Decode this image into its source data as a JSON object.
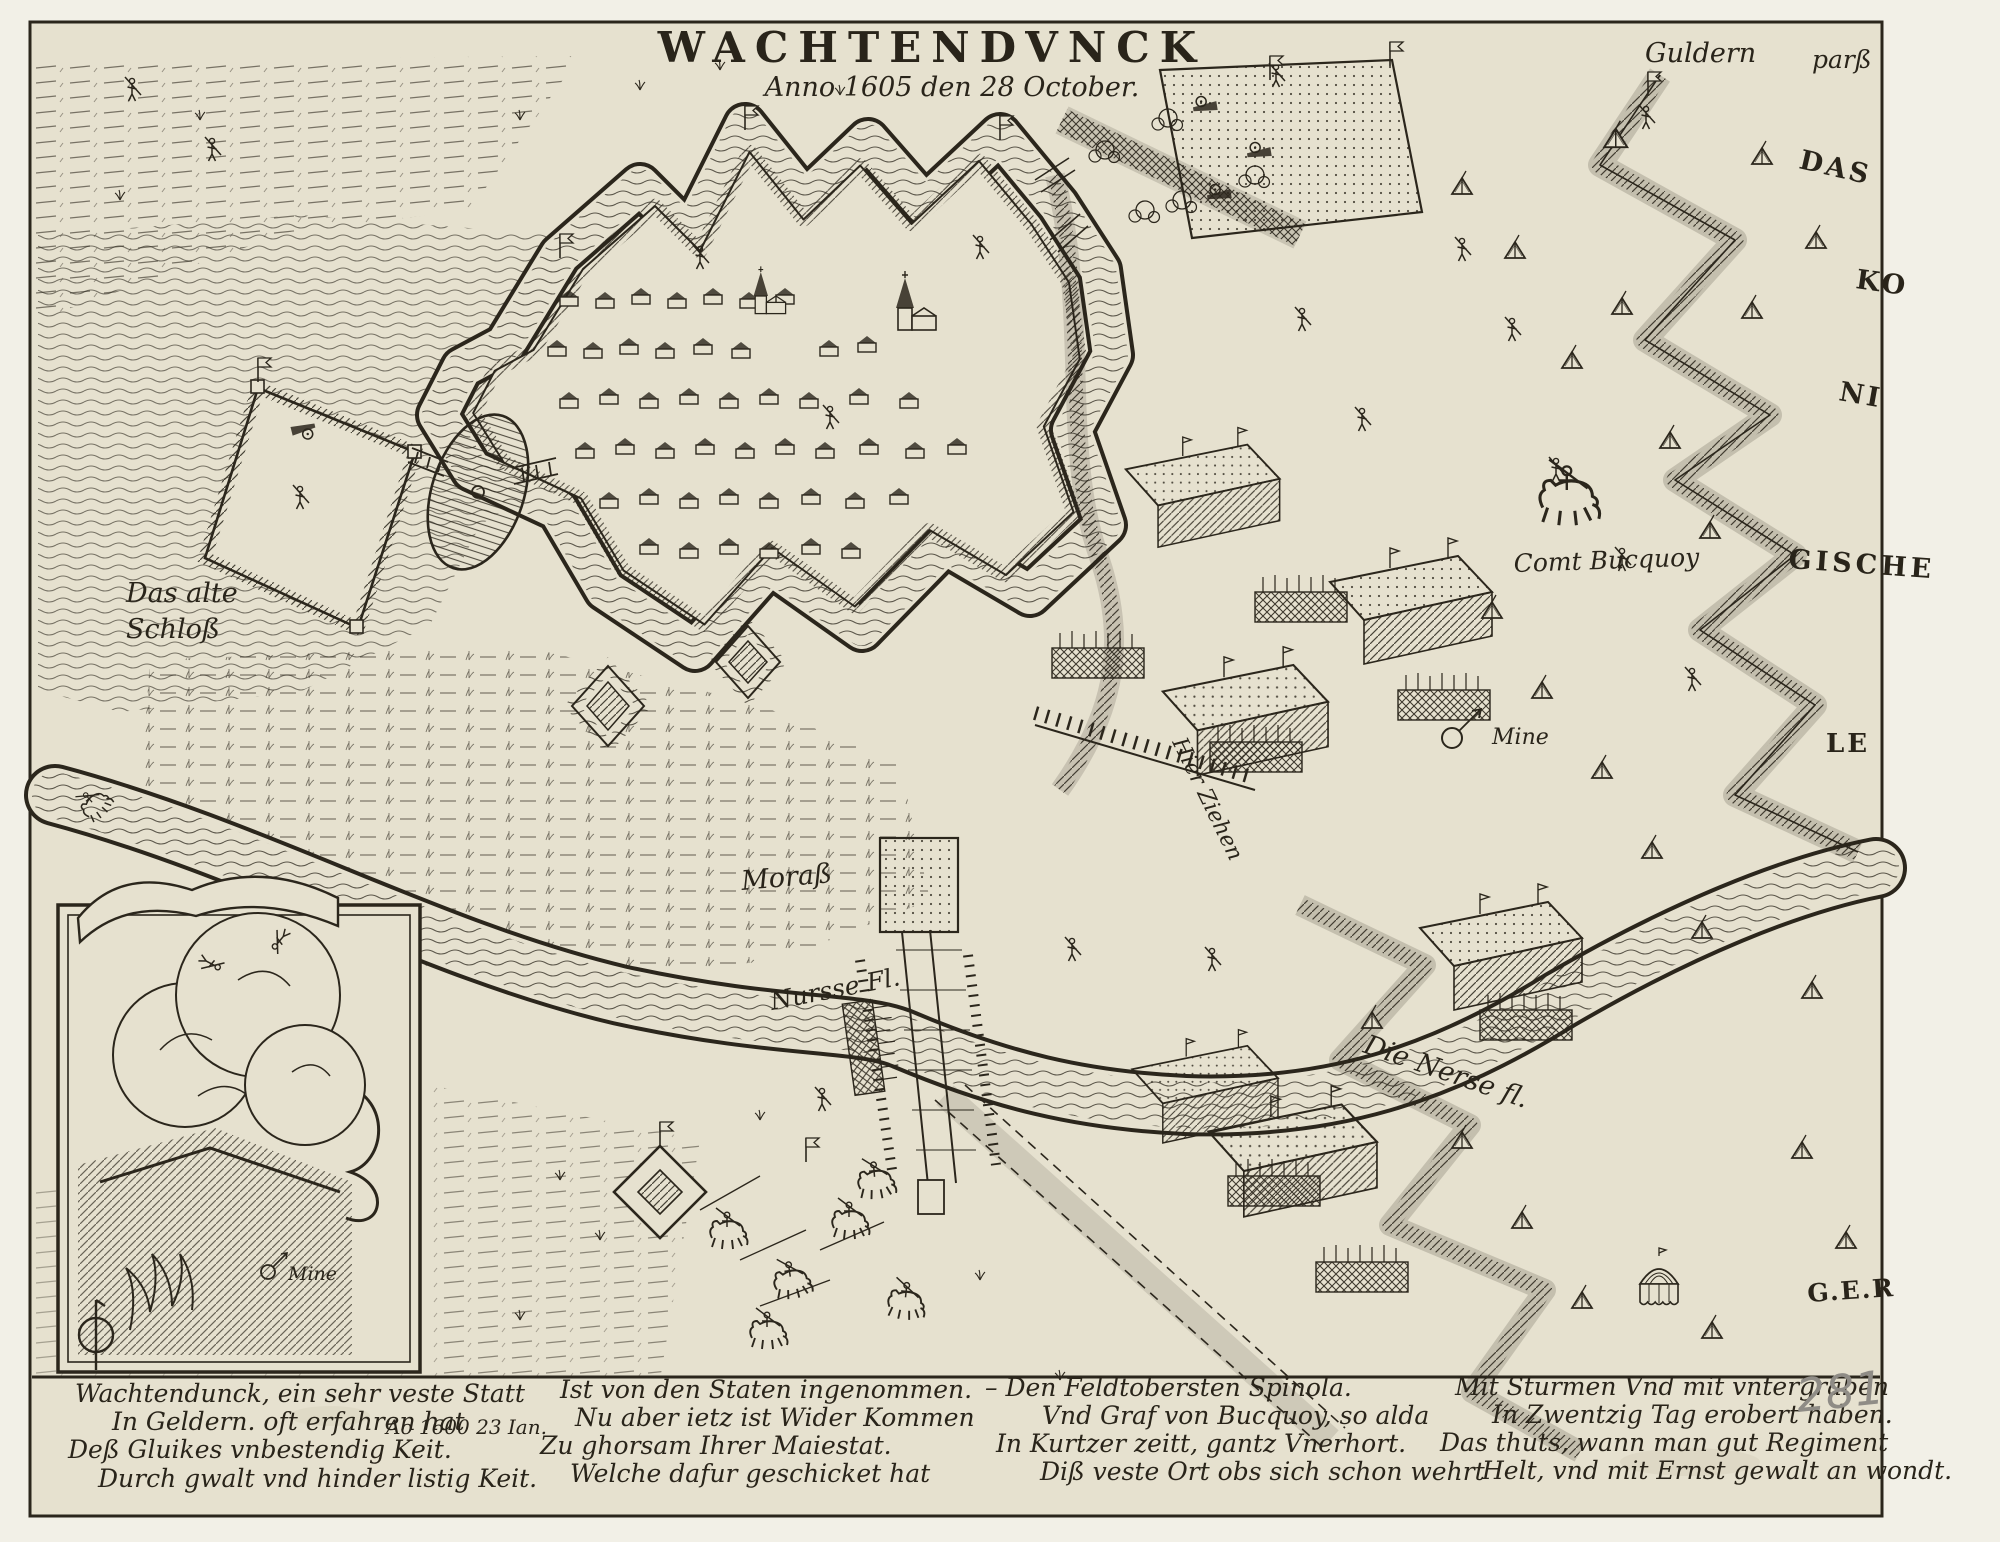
{
  "artwork": {
    "title": "WACHTENDVNCK",
    "date_line": "Anno 1605 den 28 October.",
    "page_number": "281"
  },
  "map_labels": {
    "guldern": "Guldern",
    "parss": "parß",
    "camp_das": "DAS",
    "camp_ko": "KO",
    "camp_ni": "NI",
    "camp_gische": "GISCHE",
    "camp_le": "LE",
    "camp_ger": "G.E.R",
    "old_castle_line1": "Das alte",
    "old_castle_line2": "Schloß",
    "comt_bucquoy": "Comt Bucquoy",
    "mine_camp": "Mine",
    "mine_inset": "Mine",
    "morass": "Moraß",
    "river_left": "Nursse Fl.",
    "river_right": "Die Nerse fl.",
    "hier_ziehen": "Hier Ziehen"
  },
  "inscription": {
    "note": "Ao 1600  23 Ian.",
    "blocks": [
      {
        "lines": [
          "Wachtendunck, ein sehr veste Statt",
          "In Geldern. oft erfahren hat",
          "Deß Gluikes vnbestendig Keit.",
          "Durch gwalt vnd hinder listig Keit."
        ]
      },
      {
        "lines": [
          "Ist von den Staten ingenommen.",
          "Nu aber ietz ist Wider Kommen",
          "Zu ghorsam Ihrer Maiestat.",
          "Welche dafur geschicket hat"
        ]
      },
      {
        "lines": [
          "– Den Feldtobersten Spinola.",
          "Vnd Graf von Bucquoy, so alda",
          "In Kurtzer zeitt, gantz Vnerhort.",
          "Diß veste Ort obs sich schon wehrt"
        ]
      },
      {
        "lines": [
          "Mit Sturmen Vnd mit vntergraben",
          "In Zwentzig Tag erobert haben.",
          "Das thuts, wann man gut Regiment",
          "Helt, vnd mit Ernst gewalt an wondt."
        ]
      }
    ]
  },
  "colors": {
    "paper": "#e6e1cf",
    "margin_paper": "#f2f0e7",
    "ink": "#2b261c",
    "pencil": "#8f8c86"
  }
}
